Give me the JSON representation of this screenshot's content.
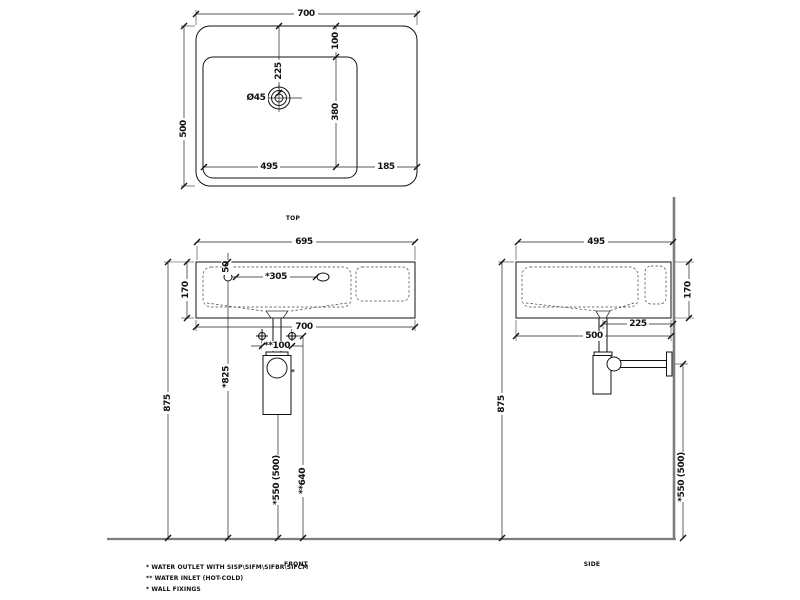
{
  "labels": {
    "top": "TOP",
    "front": "FRONT",
    "side": "SIDE"
  },
  "top_view": {
    "width": "700",
    "depth": "500",
    "bowl_inset_back": "100",
    "drain_from_back": "225",
    "drain_diameter": "Ø45",
    "bowl_depth": "380",
    "bowl_width": "495",
    "deck_width": "185"
  },
  "front_view": {
    "rim_width": "695",
    "height": "170",
    "hole_below_rim": "50",
    "hole_span": "*305",
    "width": "700",
    "inlet_spacing": "**100",
    "hole_height": "*825",
    "rim_height": "875",
    "outlet_height": "*550 (500)",
    "inlet_height": "**640",
    "outlet_marker": "*"
  },
  "side_view": {
    "rim_depth": "495",
    "height": "170",
    "drain_to_wall": "225",
    "depth": "500",
    "rim_height": "875",
    "outlet_height": "*550 (500)"
  },
  "notes": [
    "*  WATER OUTLET WITH SISP\\SIFM\\SIFBR\\SIFCM",
    "** WATER INLET  (HOT-COLD)",
    "*  WALL FIXINGS"
  ]
}
